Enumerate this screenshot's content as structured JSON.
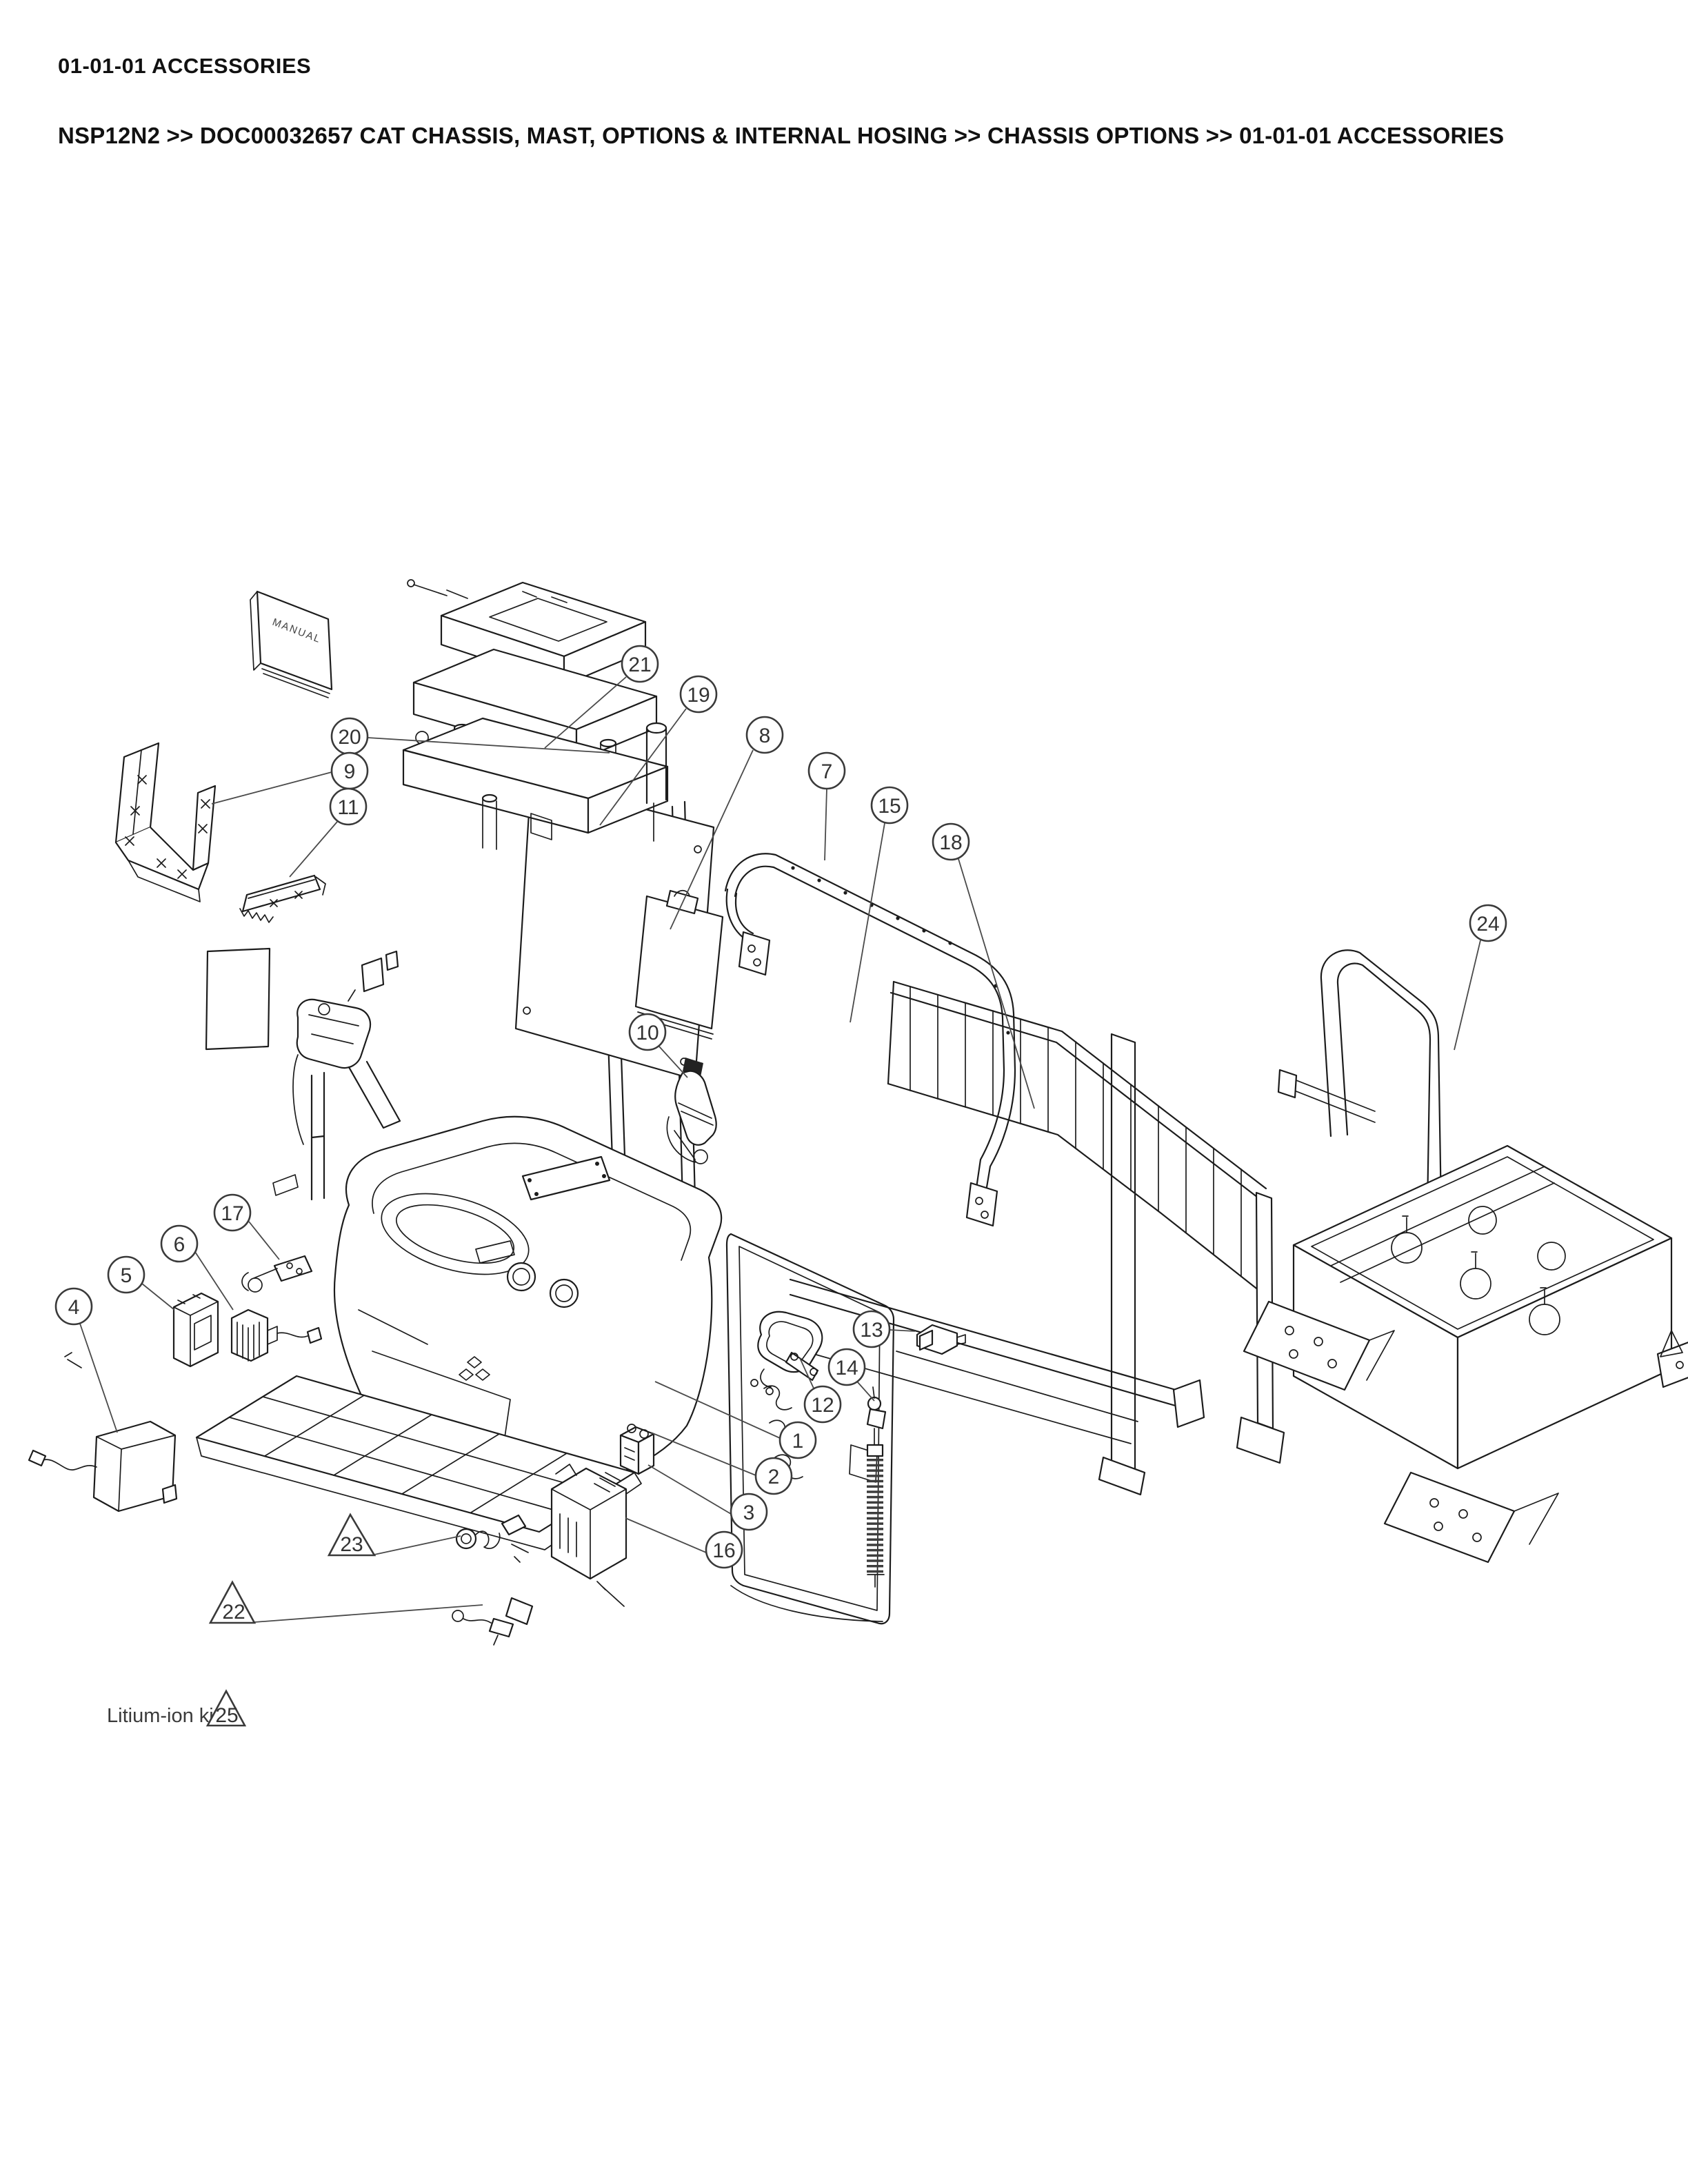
{
  "page": {
    "title": "01-01-01 ACCESSORIES",
    "breadcrumb": "NSP12N2 >> DOC00032657 CAT CHASSIS, MAST, OPTIONS & INTERNAL HOSING >> CHASSIS OPTIONS >> 01-01-01 ACCESSORIES"
  },
  "diagram": {
    "type": "exploded-parts-diagram",
    "subject": "Pallet stacker chassis accessories with numbered part callouts",
    "book_label": "MANUAL",
    "note_prefix": "Litium-ion kit:",
    "note_ref": "25",
    "callouts": {
      "c1": "1",
      "c2": "2",
      "c3": "3",
      "c4": "4",
      "c5": "5",
      "c6": "6",
      "c7": "7",
      "c8": "8",
      "c9": "9",
      "c10": "10",
      "c11": "11",
      "c12": "12",
      "c13": "13",
      "c14": "14",
      "c15": "15",
      "c16": "16",
      "c17": "17",
      "c18": "18",
      "c19": "19",
      "c20": "20",
      "c21": "21",
      "c24": "24",
      "t22": "22",
      "t23": "23",
      "t25": "25"
    },
    "ink_color": "#1c1c1c",
    "callout_color": "#3a3a3a"
  }
}
